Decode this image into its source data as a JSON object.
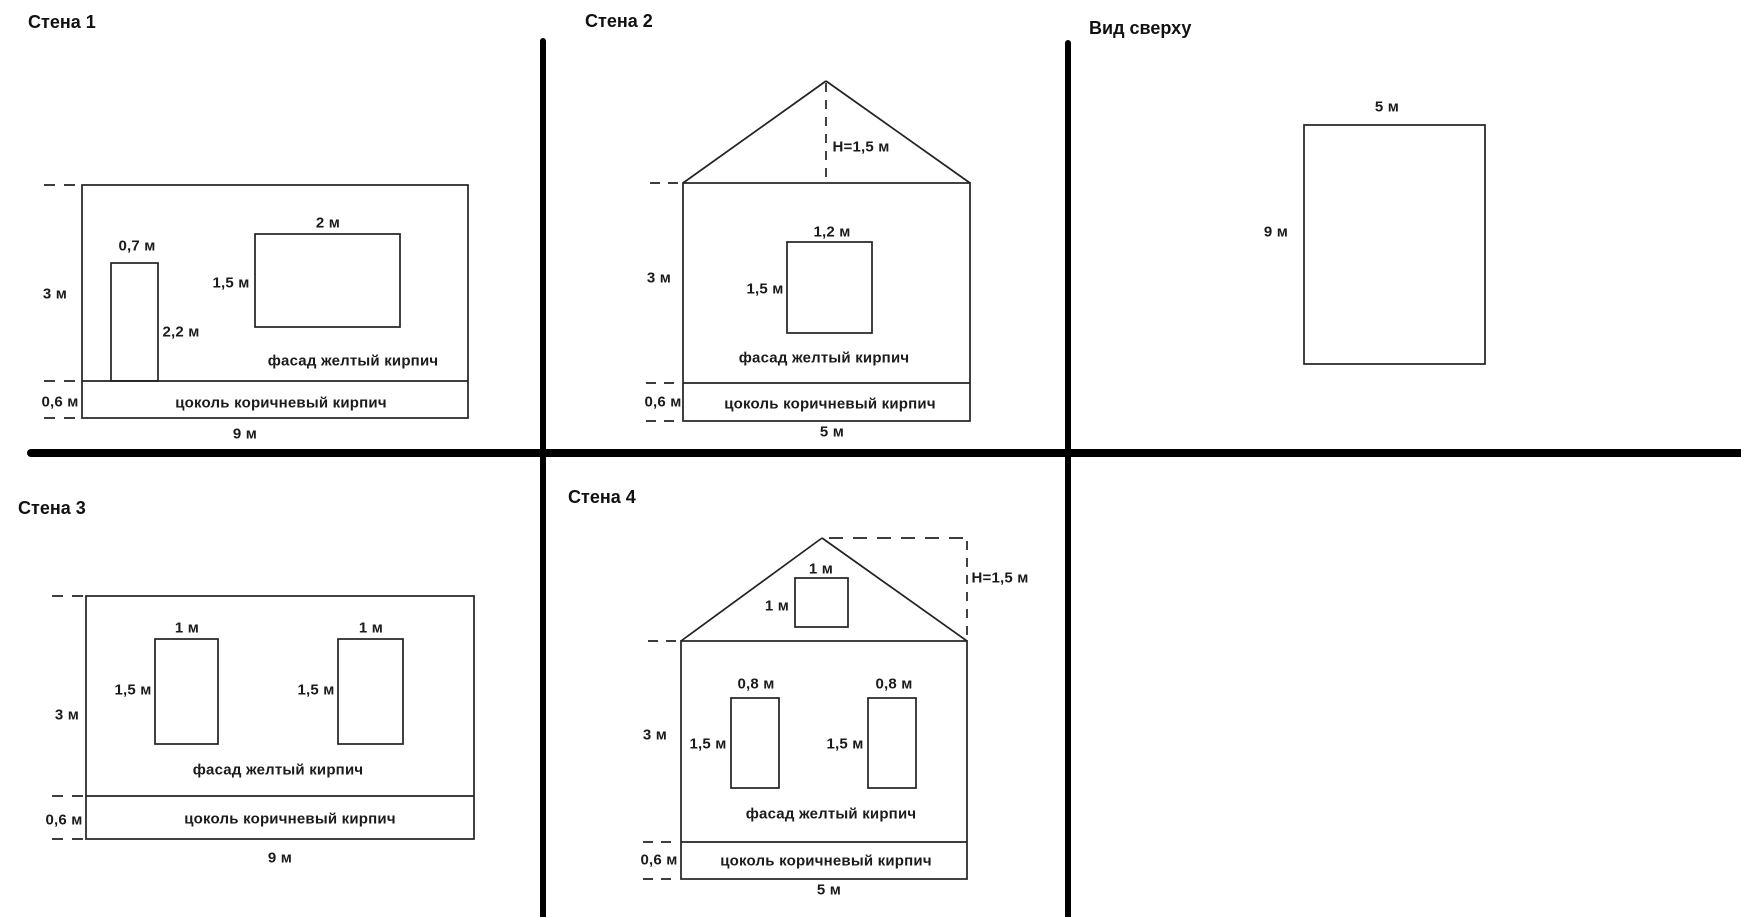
{
  "colors": {
    "line": "#222222",
    "divider": "#000000",
    "background": "#ffffff",
    "text": "#1b1b1b"
  },
  "panels": {
    "wall1": {
      "title": "Стена 1",
      "labels": {
        "door_width": "0,7 м",
        "door_height": "2,2 м",
        "window_width": "2 м",
        "window_height": "1,5 м",
        "wall_height": "3 м",
        "plinth_height": "0,6 м",
        "facade": "фасад желтый кирпич",
        "plinth": "цоколь коричневый кирпич",
        "wall_width": "9 м"
      }
    },
    "wall2": {
      "title": "Стена 2",
      "labels": {
        "roof_height": "H=1,5 м",
        "window_width": "1,2 м",
        "window_height": "1,5 м",
        "wall_height": "3 м",
        "plinth_height": "0,6 м",
        "facade": "фасад желтый кирпич",
        "plinth": "цоколь коричневый кирпич",
        "wall_width": "5 м"
      }
    },
    "top_view": {
      "title": "Вид сверху",
      "labels": {
        "width": "5 м",
        "depth": "9 м"
      }
    },
    "wall3": {
      "title": "Стена 3",
      "labels": {
        "window1_width": "1 м",
        "window2_width": "1 м",
        "window1_height": "1,5 м",
        "window2_height": "1,5 м",
        "wall_height": "3 м",
        "plinth_height": "0,6 м",
        "facade": "фасад желтый кирпич",
        "plinth": "цоколь коричневый кирпич",
        "wall_width": "9 м"
      }
    },
    "wall4": {
      "title": "Стена 4",
      "labels": {
        "roof_height": "H=1,5 м",
        "attic_window_width": "1 м",
        "attic_window_height": "1 м",
        "window1_width": "0,8 м",
        "window2_width": "0,8 м",
        "window1_height": "1,5 м",
        "window2_height": "1,5 м",
        "wall_height": "3 м",
        "plinth_height": "0,6 м",
        "facade": "фасад желтый кирпич",
        "plinth": "цоколь коричневый кирпич",
        "wall_width": "5 м"
      }
    }
  }
}
